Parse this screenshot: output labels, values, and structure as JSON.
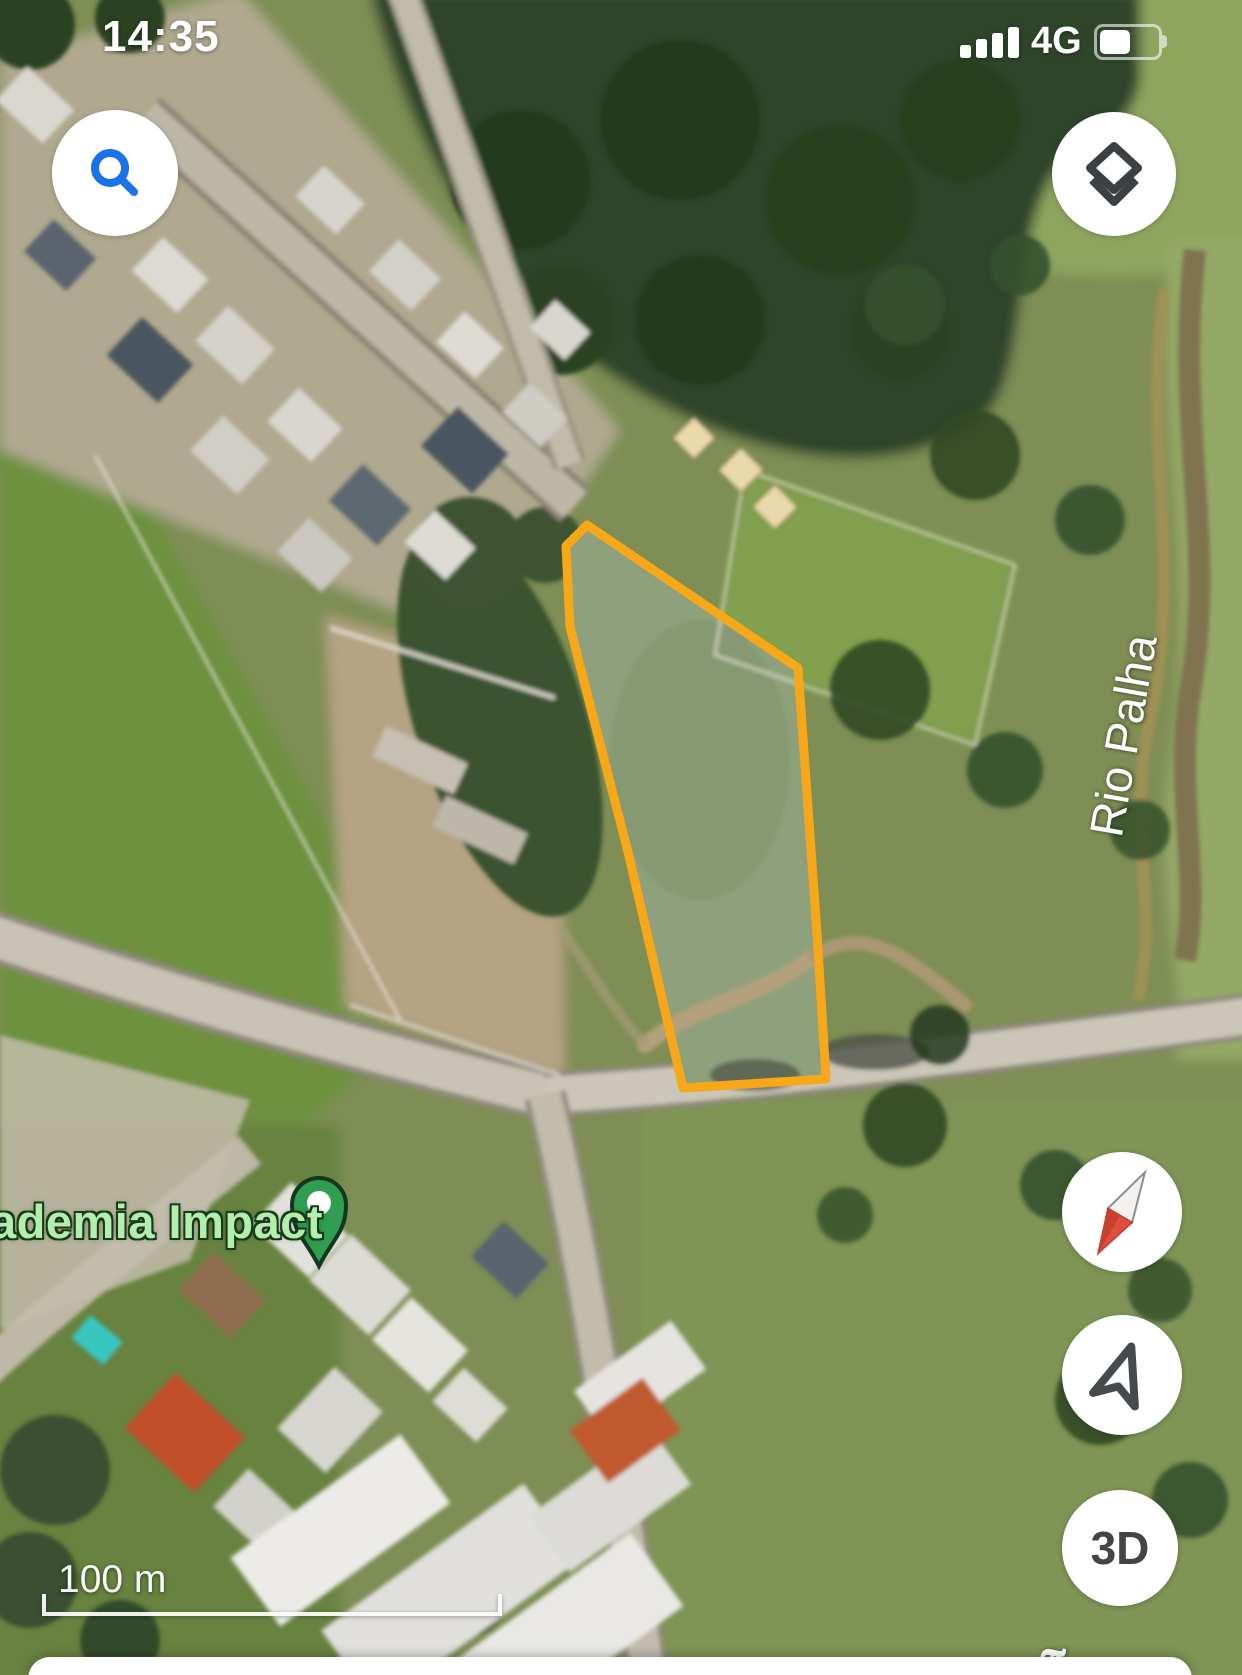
{
  "status_bar": {
    "time": "14:35",
    "network": "4G"
  },
  "controls": {
    "threed_label": "3D",
    "icons": {
      "search": "magnifier-icon",
      "layers": "stacked-layers-icon",
      "compass": "compass-needle-icon",
      "my_location": "navigation-arrow-icon"
    }
  },
  "map": {
    "place_label": "ademia Impact",
    "river_label": "Rio Palha",
    "street_label_partial": "a",
    "scale_label": "100 m",
    "parcel_outline_points": "587,525 566,546 570,627 628,852 683,1088 826,1079 817,933 798,668",
    "colors": {
      "parcel_stroke": "#F7A818",
      "pin_green": "#2F9E50",
      "place_label_fill": "#B4EEAE",
      "search_blue": "#1A73E8",
      "icon_gray": "#3C4043"
    }
  }
}
